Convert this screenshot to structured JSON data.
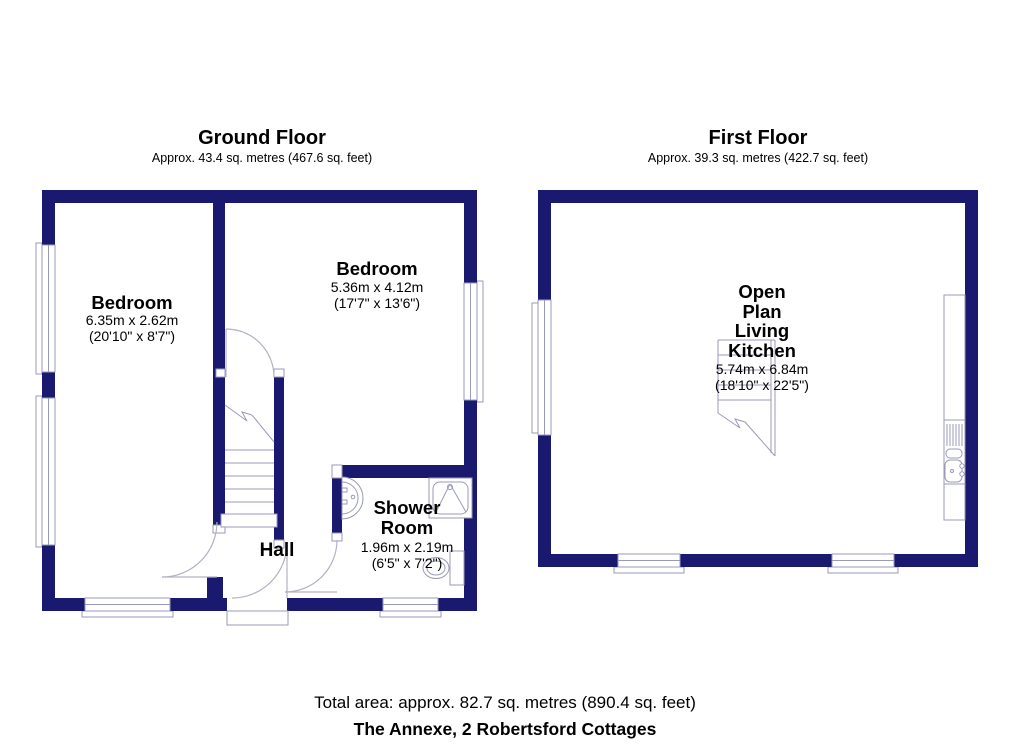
{
  "colors": {
    "wall": "#191970",
    "line": "#9a9ab8",
    "door": "#b2b2c4"
  },
  "ground_floor": {
    "title": "Ground Floor",
    "area": "Approx. 43.4 sq. metres (467.6 sq. feet)",
    "bedroom1": {
      "name": "Bedroom",
      "metric": "6.35m x 2.62m",
      "imperial": "(20'10\" x 8'7\")"
    },
    "bedroom2": {
      "name": "Bedroom",
      "metric": "5.36m x 4.12m",
      "imperial": "(17'7\" x 13'6\")"
    },
    "shower_room": {
      "name_line1": "Shower",
      "name_line2": "Room",
      "metric": "1.96m x 2.19m",
      "imperial": "(6'5\" x 7'2\")"
    },
    "hall": {
      "name": "Hall"
    }
  },
  "first_floor": {
    "title": "First Floor",
    "area": "Approx. 39.3 sq. metres (422.7 sq. feet)",
    "open_plan": {
      "name_line1": "Open",
      "name_line2": "Plan",
      "name_line3": "Living",
      "name_line4": "Kitchen",
      "metric": "5.74m x 6.84m",
      "imperial": "(18'10\" x 22'5\")"
    }
  },
  "footer": {
    "total_area": "Total area: approx. 82.7 sq. metres (890.4 sq. feet)",
    "property_name": "The Annexe, 2 Robertsford Cottages"
  }
}
